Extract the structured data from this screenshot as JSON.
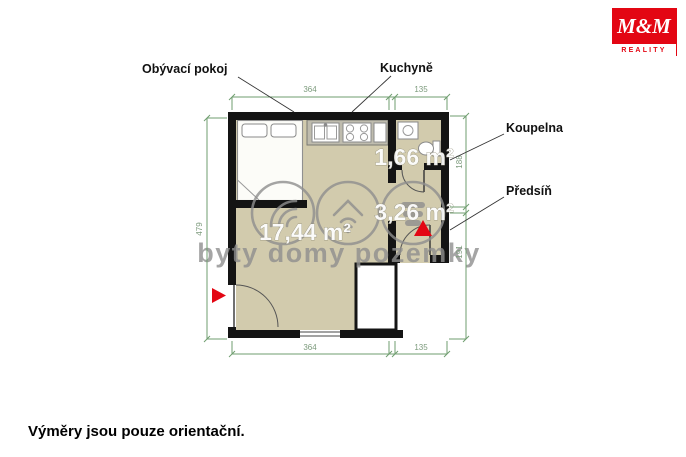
{
  "logo": {
    "brand": "M&M",
    "subtitle": "REALITY"
  },
  "plan": {
    "labels": {
      "living_room": "Obývací pokoj",
      "kitchen": "Kuchyně",
      "bathroom": "Koupelna",
      "hallway": "Předsíň"
    },
    "areas": {
      "living_room": "17,44 m²",
      "bathroom": "1,66 m²",
      "hallway": "3,26 m²"
    },
    "dimensions": {
      "top_width_main": "364",
      "top_width_side": "135",
      "bottom_width_main": "364",
      "bottom_width_side": "135",
      "left_height": "479",
      "right_height_upper": "188",
      "right_height_lower": "191"
    }
  },
  "watermark": {
    "text": "byty domy pozemky"
  },
  "footer": {
    "disclaimer": "Výměry jsou pouze orientační."
  },
  "colors": {
    "wall": "#141414",
    "floor": "#d2cbad",
    "counter": "#bfbcae",
    "dimension_green": "#6f9e6f",
    "accent_red": "#e30613",
    "watermark_gray": "#8f8f8f"
  }
}
